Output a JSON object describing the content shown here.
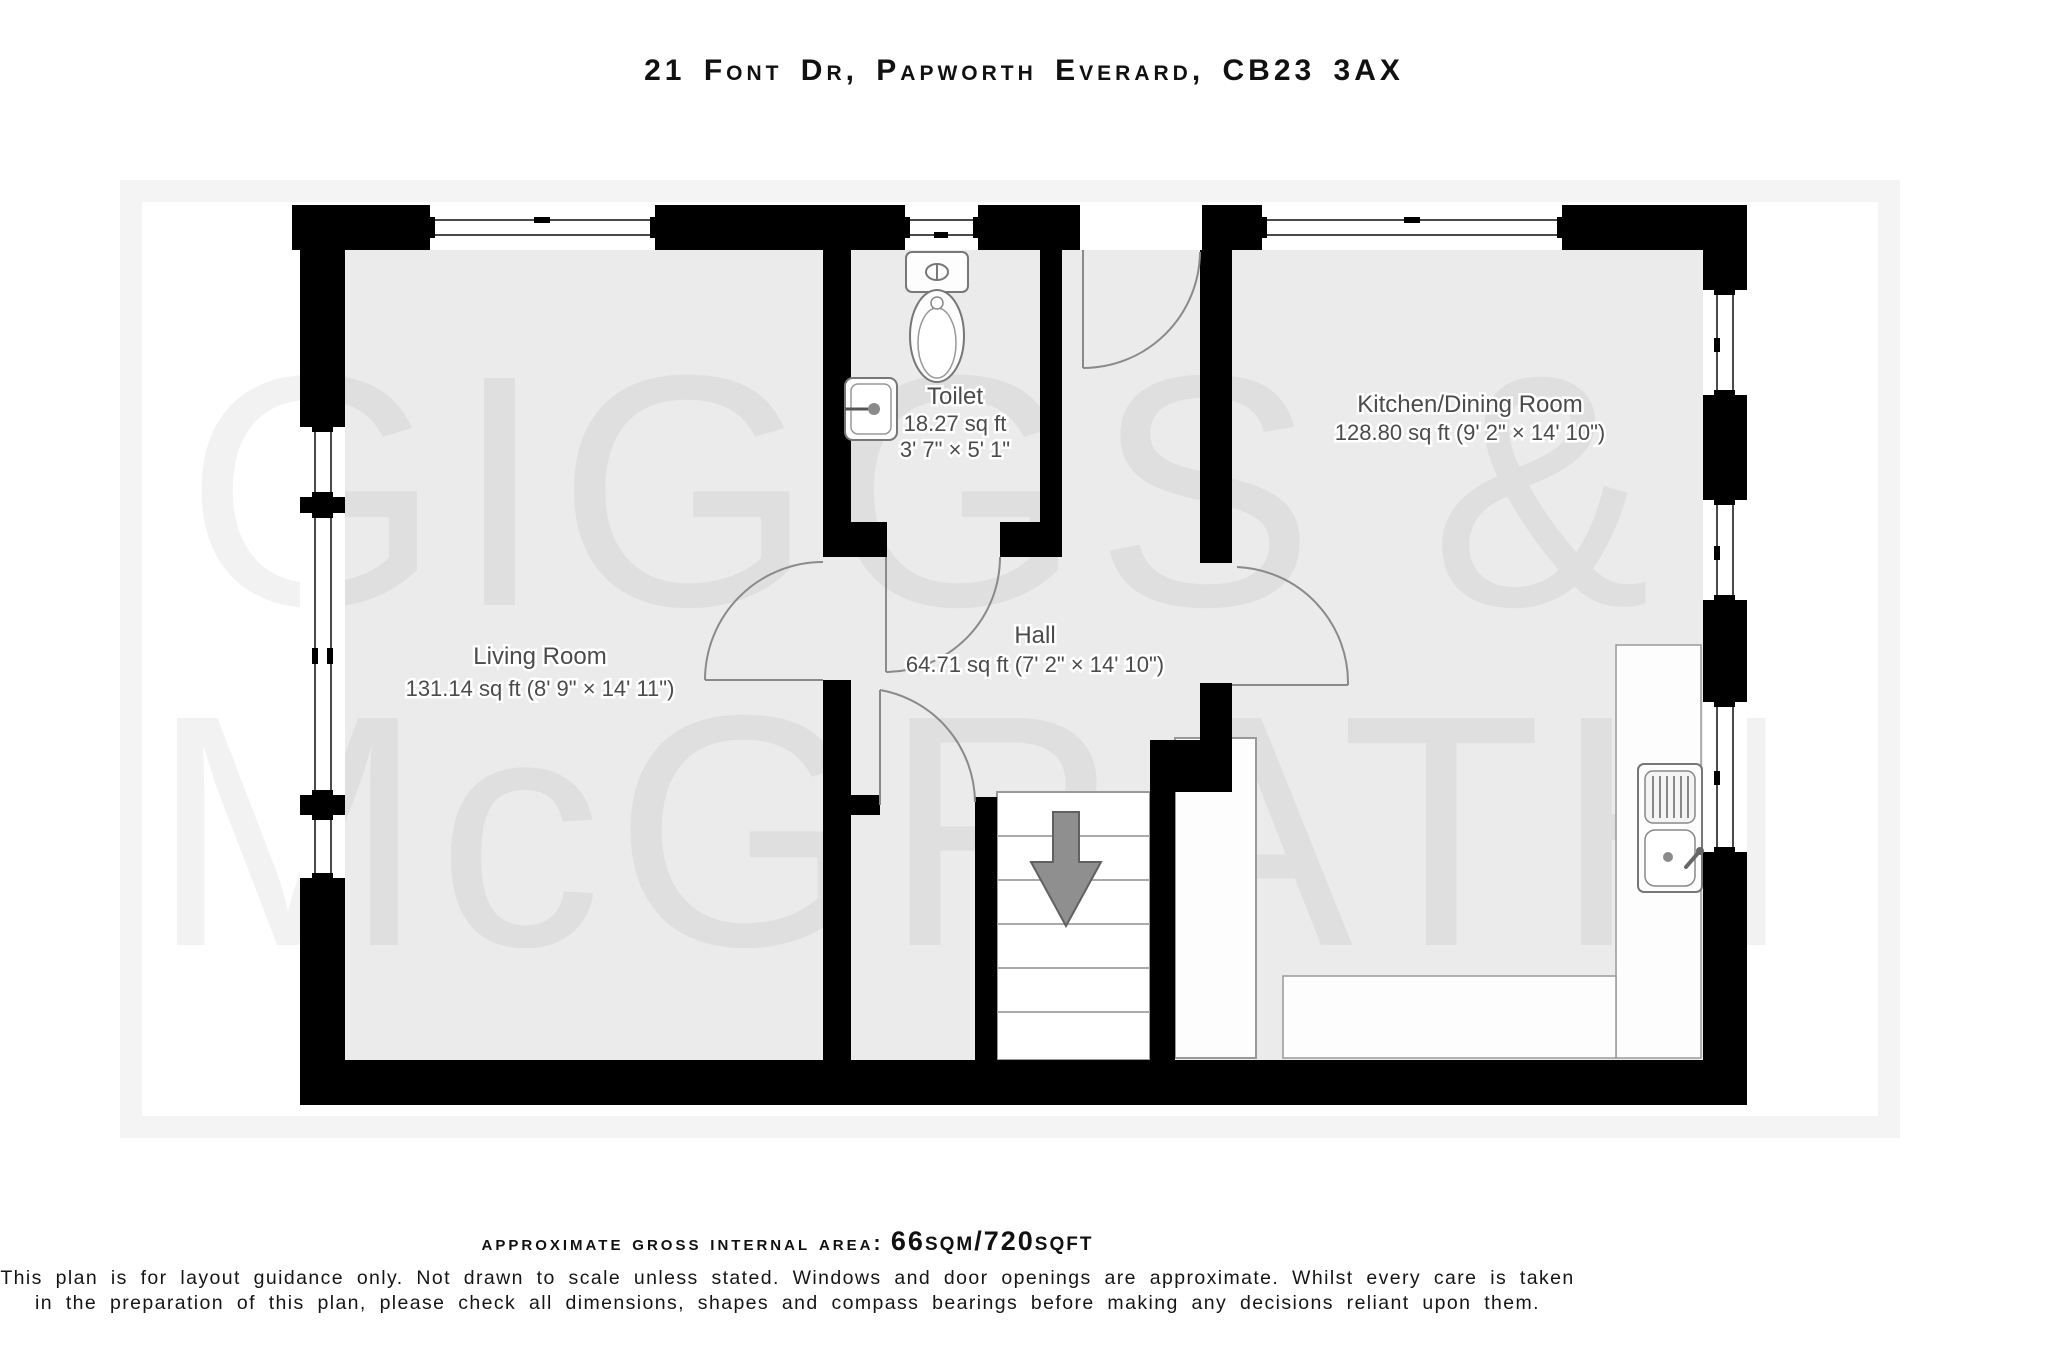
{
  "header": {
    "title": "21 Font Dr, Papworth Everard, CB23 3AX"
  },
  "watermark": {
    "line1": "GIGGS &",
    "line2": "McGRATH"
  },
  "plan": {
    "rooms": [
      {
        "name": "Living Room",
        "details": "131.14 sq ft (8' 9\" × 14' 11\")"
      },
      {
        "name": "Toilet",
        "area": "18.27 sq ft",
        "dims": "3' 7\" × 5' 1\""
      },
      {
        "name": "Hall",
        "details": "64.71 sq ft (7' 2\" × 14' 10\")"
      },
      {
        "name": "Kitchen/Dining Room",
        "details": "128.80 sq ft (9' 2\" × 14' 10\")"
      }
    ],
    "fixtures": [
      "toilet-wc",
      "toilet-sink",
      "kitchen-sink",
      "stairs-down",
      "kitchen-counters",
      "storage-unit"
    ],
    "stairs_direction": "down",
    "colors": {
      "wall": "#000000",
      "room_fill": "#ebebeb",
      "label_text": "#4b4b4b"
    }
  },
  "footer": {
    "area_label": "approximate gross internal area:",
    "area_value": "66sqm/720sqft",
    "disclaimer_line1": "This plan is for layout guidance only. Not drawn to scale unless stated. Windows and door openings are approximate. Whilst every care is taken",
    "disclaimer_line2": "in the preparation of this plan, please check all dimensions, shapes and compass bearings before making any decisions reliant upon them."
  }
}
